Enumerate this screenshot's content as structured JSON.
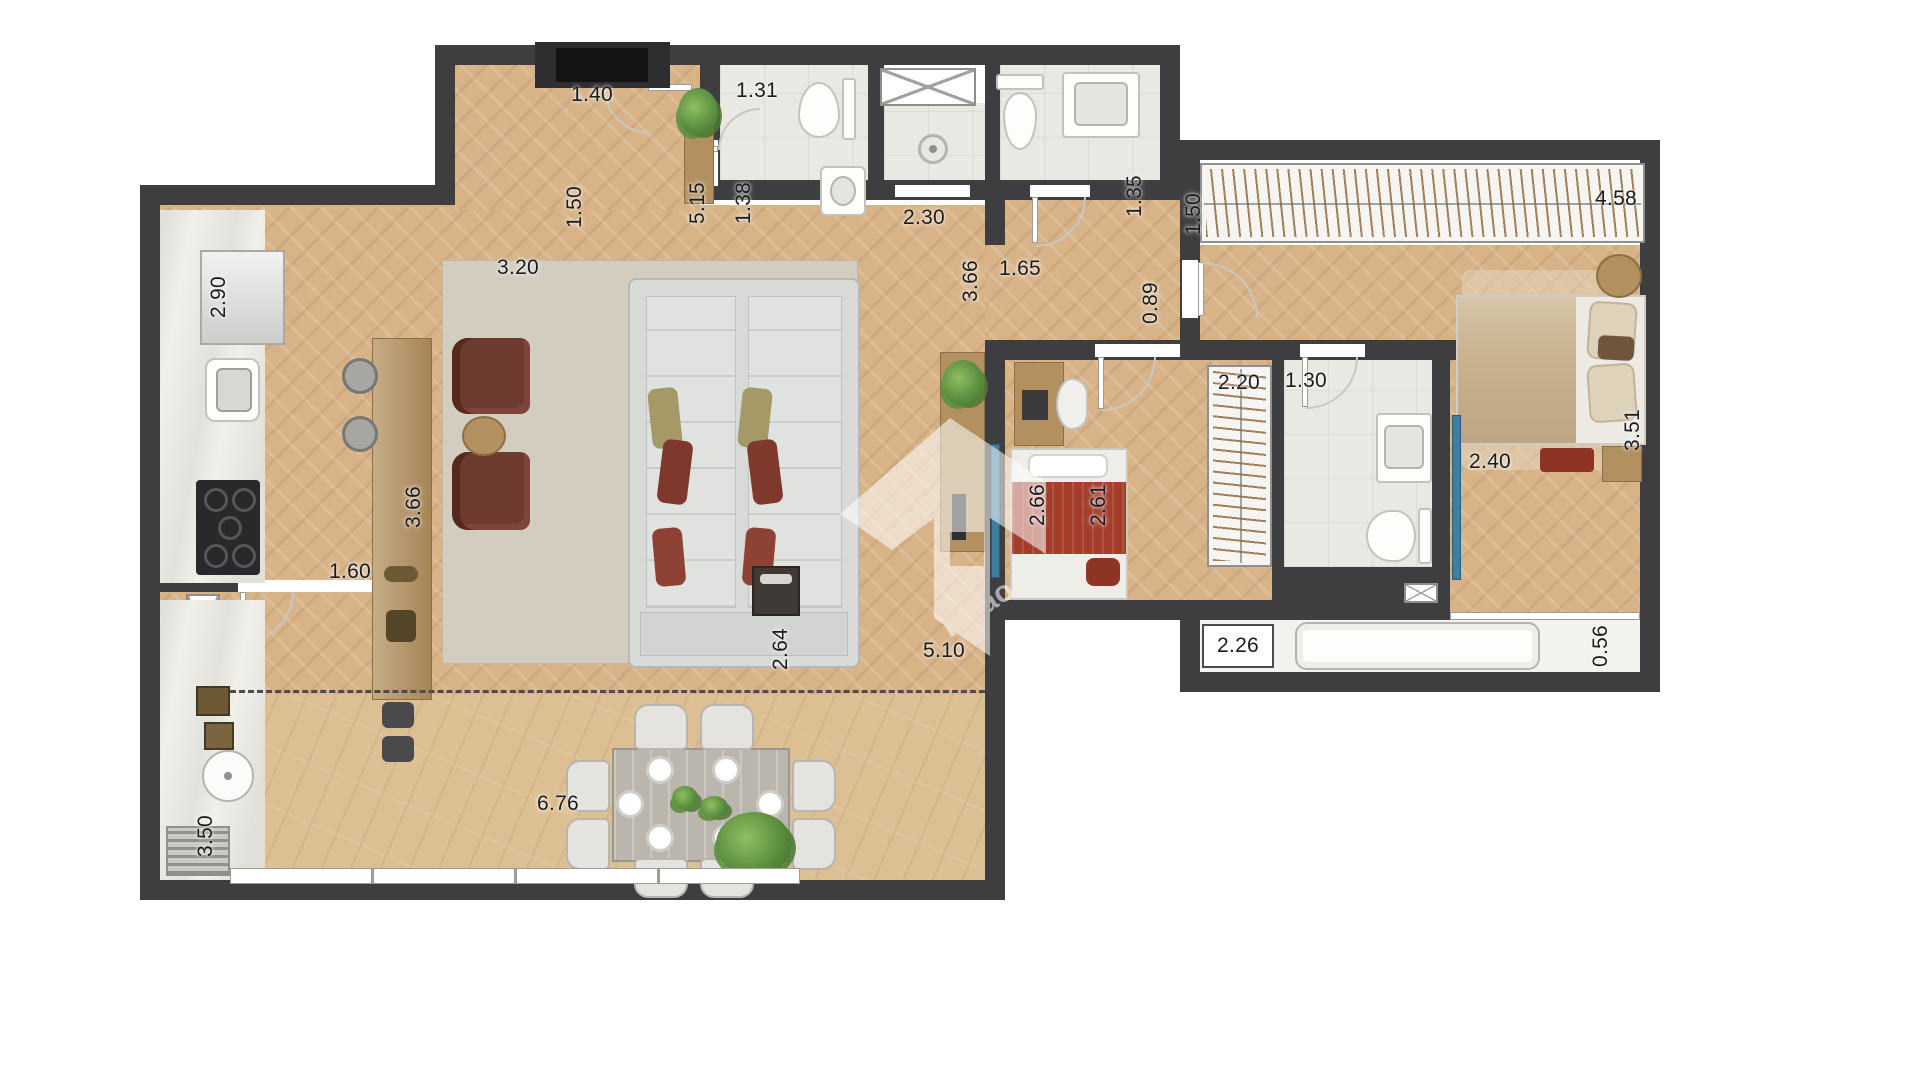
{
  "plan": {
    "watermark": {
      "text": "razão"
    },
    "colors": {
      "wall": "#3e3e40",
      "wood_floor": "#d8b388",
      "terrace_floor": "#ddbf94",
      "bath_floor": "#eae8e3",
      "marble": "#f1efe9",
      "accent_red": "#a53d2b",
      "olive": "#a59a67",
      "sofa_gray": "#d8dad7",
      "rug": "#d3cdc0",
      "furniture_wood": "#b2905f",
      "tv_blue": "#3d7fa3",
      "plant_green": "#5c8f3f"
    },
    "dimension_labels": [
      {
        "text": "1.40",
        "x": 592,
        "y": 95,
        "vertical": false
      },
      {
        "text": "1.50",
        "x": 575,
        "y": 207,
        "vertical": true
      },
      {
        "text": "5.15",
        "x": 698,
        "y": 203,
        "vertical": true
      },
      {
        "text": "3.20",
        "x": 518,
        "y": 268,
        "vertical": false
      },
      {
        "text": "2.90",
        "x": 219,
        "y": 297,
        "vertical": true
      },
      {
        "text": "1.31",
        "x": 757,
        "y": 91,
        "vertical": false
      },
      {
        "text": "1.38",
        "x": 744,
        "y": 203,
        "vertical": true
      },
      {
        "text": "2.30",
        "x": 924,
        "y": 218,
        "vertical": false
      },
      {
        "text": "1.35",
        "x": 1135,
        "y": 196,
        "vertical": true
      },
      {
        "text": "1.50",
        "x": 1194,
        "y": 214,
        "vertical": true
      },
      {
        "text": "4.58",
        "x": 1616,
        "y": 199,
        "vertical": false
      },
      {
        "text": "3.66",
        "x": 971,
        "y": 281,
        "vertical": true
      },
      {
        "text": "1.65",
        "x": 1020,
        "y": 269,
        "vertical": false
      },
      {
        "text": "0.89",
        "x": 1151,
        "y": 303,
        "vertical": true
      },
      {
        "text": "2.20",
        "x": 1239,
        "y": 383,
        "vertical": false
      },
      {
        "text": "1.30",
        "x": 1306,
        "y": 381,
        "vertical": false
      },
      {
        "text": "3.66",
        "x": 414,
        "y": 507,
        "vertical": true
      },
      {
        "text": "1.60",
        "x": 350,
        "y": 572,
        "vertical": false
      },
      {
        "text": "2.40",
        "x": 1490,
        "y": 462,
        "vertical": false
      },
      {
        "text": "3.51",
        "x": 1633,
        "y": 430,
        "vertical": true
      },
      {
        "text": "5.10",
        "x": 944,
        "y": 651,
        "vertical": false
      },
      {
        "text": "2.66",
        "x": 1038,
        "y": 505,
        "vertical": true
      },
      {
        "text": "2.61",
        "x": 1099,
        "y": 505,
        "vertical": true
      },
      {
        "text": "2.64",
        "x": 781,
        "y": 649,
        "vertical": true
      },
      {
        "text": "6.76",
        "x": 558,
        "y": 804,
        "vertical": false
      },
      {
        "text": "3.50",
        "x": 206,
        "y": 836,
        "vertical": true
      },
      {
        "text": "0.56",
        "x": 1601,
        "y": 646,
        "vertical": true
      },
      {
        "text": "2.26",
        "x": 1238,
        "y": 646,
        "vertical": false
      }
    ]
  }
}
